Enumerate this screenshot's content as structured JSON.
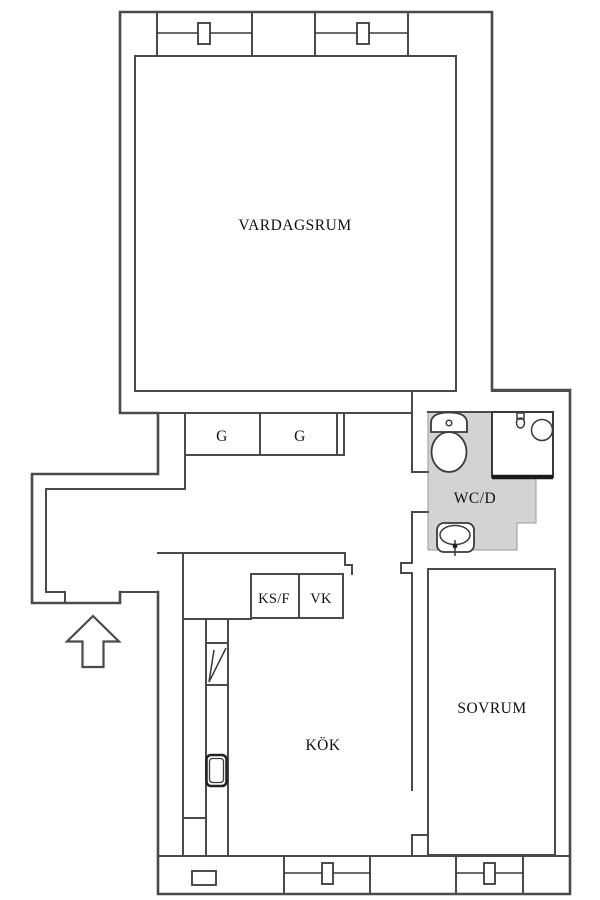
{
  "title": "Apartment floor plan",
  "labels": {
    "living_room": "VARDAGSRUM",
    "wardrobe_1": "G",
    "wardrobe_2": "G",
    "bathroom": "WC/D",
    "closet_ksf": "KS/F",
    "closet_vk": "VK",
    "kitchen": "KÖK",
    "bedroom": "SOVRUM"
  },
  "colors": {
    "wall": "#4a4a4a",
    "line": "#3a3a3a",
    "bathroom_floor": "#d3d3d3",
    "background": "#ffffff",
    "text": "#111111"
  }
}
